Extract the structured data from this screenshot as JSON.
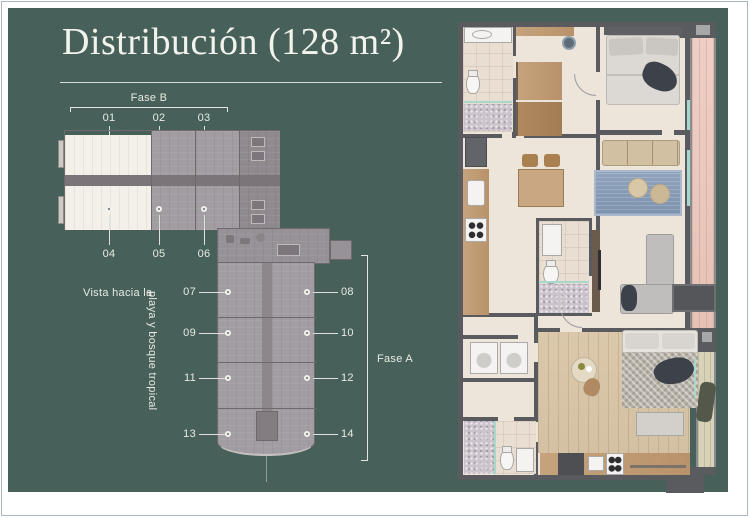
{
  "title": "Distribución (128 m²)",
  "site_plan": {
    "fase_b": {
      "label": "Fase B",
      "top_units": [
        "01",
        "02",
        "03"
      ],
      "bottom_units": [
        "04",
        "05",
        "06"
      ]
    },
    "fase_a": {
      "label": "Fase A",
      "left_units": [
        "07",
        "09",
        "11",
        "13"
      ],
      "right_units": [
        "08",
        "10",
        "12",
        "14"
      ]
    },
    "view_text_1": "Vista hacia la",
    "view_text_2": "playa y bosque tropical"
  },
  "palette": {
    "panel_green": "#47615A",
    "page_white": "#FFFFFF",
    "label_text": "#E8EBE4",
    "plan_wall": "#5A5B5F",
    "plan_floor": "#EDE4DA",
    "terrace_wood": "#EBCBC1",
    "bedroom_wood": "#D9C6A9",
    "rug_blue": "#8FA3BC",
    "building_gray": "#A29DA2",
    "unit_highlight": "#F3EFE9"
  }
}
